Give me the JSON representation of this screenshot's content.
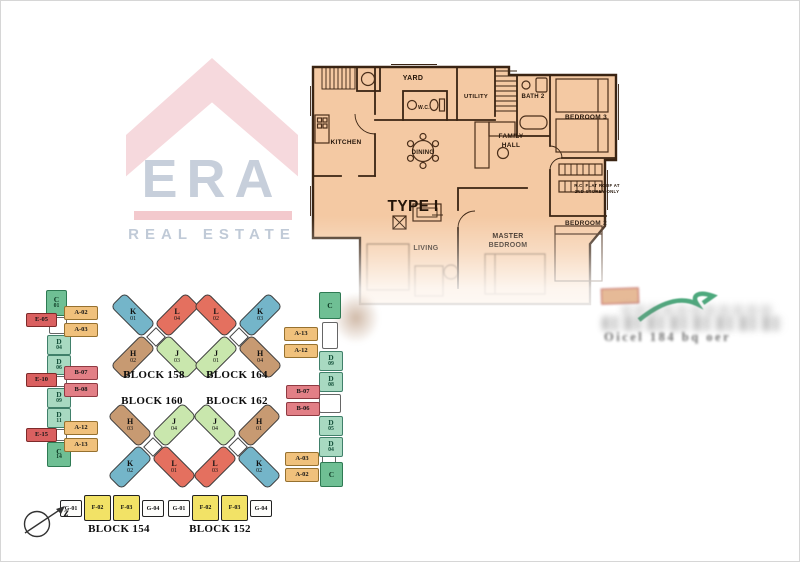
{
  "logo": {
    "brand": "ERA",
    "tagline": "REAL ESTATE"
  },
  "floorplan": {
    "type_label": "TYPE I",
    "rooms": {
      "yard": "YARD",
      "wc": "W.C.",
      "utility": "UTILITY",
      "bath2": "BATH 2",
      "bedroom3": "BEDROOM 3",
      "kitchen": "KITCHEN",
      "dining": "DINING",
      "family1": "FAMILY",
      "family2": "HALL",
      "living": "LIVING",
      "master1": "MASTER",
      "master2": "BEDROOM",
      "bedroom2": "BEDROOM 2",
      "note1": "R.C. FLAT ROOF AT",
      "note2": "2ND STOREY ONLY"
    }
  },
  "siteplan": {
    "left_strip": [
      {
        "letter": "C",
        "num": "01"
      },
      {
        "label": "E-05"
      },
      {
        "label": "A-02"
      },
      {
        "label": "A-03"
      },
      {
        "letter": "D",
        "num": "04"
      },
      {
        "letter": "D",
        "num": "06"
      },
      {
        "label": "E-10"
      },
      {
        "label": "B-07"
      },
      {
        "label": "B-08"
      },
      {
        "letter": "D",
        "num": "09"
      },
      {
        "letter": "D",
        "num": "11"
      },
      {
        "label": "E-15"
      },
      {
        "label": "A-12"
      },
      {
        "label": "A-13"
      },
      {
        "letter": "C",
        "num": "14"
      }
    ],
    "right_strip": [
      {
        "letter": "C"
      },
      {
        "label": "A-13"
      },
      {
        "label": "A-12"
      },
      {
        "letter": "D",
        "num": "09"
      },
      {
        "letter": "D",
        "num": "08"
      },
      {
        "label": "B-07"
      },
      {
        "label": "B-06"
      },
      {
        "letter": "D",
        "num": "05"
      },
      {
        "letter": "D",
        "num": "04"
      },
      {
        "label": "A-03"
      },
      {
        "label": "A-02"
      },
      {
        "letter": "C"
      }
    ],
    "x_blocks": [
      {
        "name": "BLOCK 158",
        "tl": {
          "letter": "K",
          "num": "01"
        },
        "tr": {
          "letter": "L",
          "num": "04"
        },
        "bl": {
          "letter": "H",
          "num": "02"
        },
        "br": {
          "letter": "J",
          "num": "03"
        }
      },
      {
        "name": "BLOCK 164",
        "tl": {
          "letter": "L",
          "num": "02"
        },
        "tr": {
          "letter": "K",
          "num": "03"
        },
        "bl": {
          "letter": "J",
          "num": "01"
        },
        "br": {
          "letter": "H",
          "num": "04"
        }
      },
      {
        "name": "BLOCK 160",
        "tl": {
          "letter": "H",
          "num": "03"
        },
        "tr": {
          "letter": "J",
          "num": "04"
        },
        "bl": {
          "letter": "K",
          "num": "02"
        },
        "br": {
          "letter": "L",
          "num": "01"
        }
      },
      {
        "name": "BLOCK 162",
        "tl": {
          "letter": "J",
          "num": "04"
        },
        "tr": {
          "letter": "H",
          "num": "01"
        },
        "bl": {
          "letter": "L",
          "num": "03"
        },
        "br": {
          "letter": "K",
          "num": "02"
        }
      }
    ],
    "row_blocks": [
      {
        "name": "BLOCK 154",
        "units": [
          "G-01",
          "F-02",
          "F-03",
          "G-04"
        ]
      },
      {
        "name": "BLOCK 152",
        "units": [
          "G-01",
          "F-02",
          "F-03",
          "G-04"
        ]
      }
    ],
    "compass_label": "z"
  },
  "watermark": {
    "text": "Oicel 184 bq oer"
  },
  "colors": {
    "plan_fill": "#f4c9a3",
    "wall": "#3a2413",
    "unit_a": "#f0c17c",
    "unit_b": "#e27f86",
    "unit_c": "#6fbf94",
    "unit_d": "#a8d9c1",
    "unit_e": "#da6060",
    "unit_f": "#f2e266",
    "unit_g": "#fdfdfb",
    "wing_h": "#c79a72",
    "wing_j": "#c9e7ad",
    "wing_k": "#74b5c9",
    "wing_l": "#e4705f",
    "logo_roof_pink": "#f6d9dd",
    "logo_text_gray": "#c7cfdb",
    "logo_bar_pink": "#f3c9cd",
    "swoosh_green": "#2e9a66"
  }
}
